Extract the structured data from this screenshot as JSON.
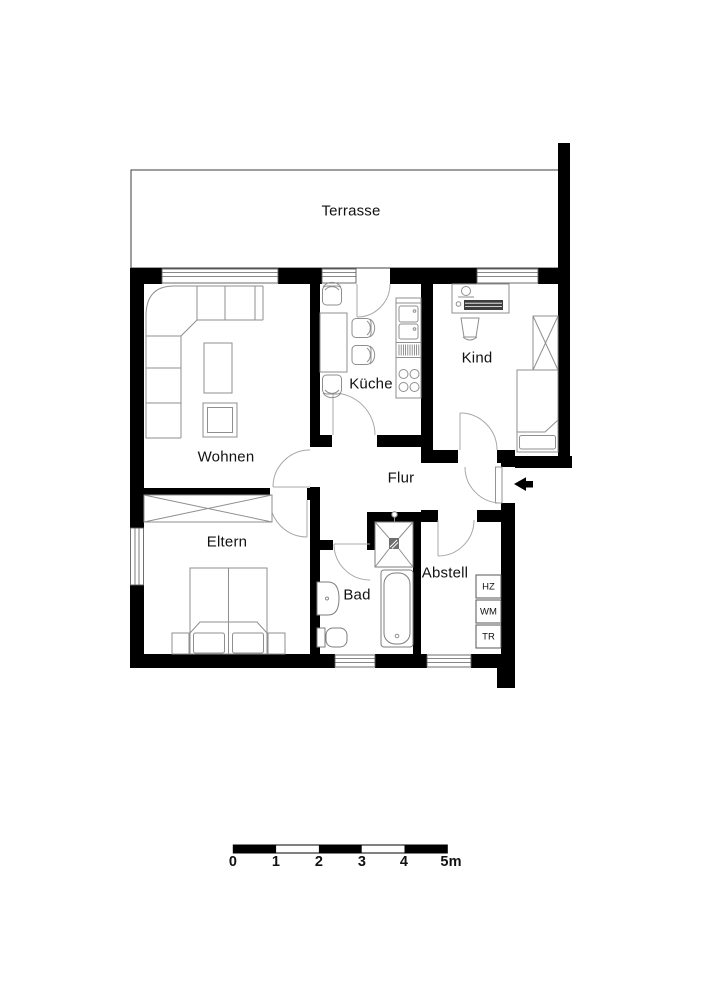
{
  "plan": {
    "rooms": {
      "terrasse": "Terrasse",
      "wohnen": "Wohnen",
      "kueche": "Küche",
      "kind": "Kind",
      "flur": "Flur",
      "eltern": "Eltern",
      "bad": "Bad",
      "abstell": "Abstell"
    },
    "utility_units": {
      "hz": "HZ",
      "wm": "WM",
      "tr": "TR"
    },
    "scale_bar": {
      "labels": [
        "0",
        "1",
        "2",
        "3",
        "4",
        "5m"
      ]
    },
    "colors": {
      "wall": "#000000",
      "background": "#ffffff",
      "furniture_line": "#8f8f8f",
      "door_arc": "#a8a8a8"
    }
  }
}
